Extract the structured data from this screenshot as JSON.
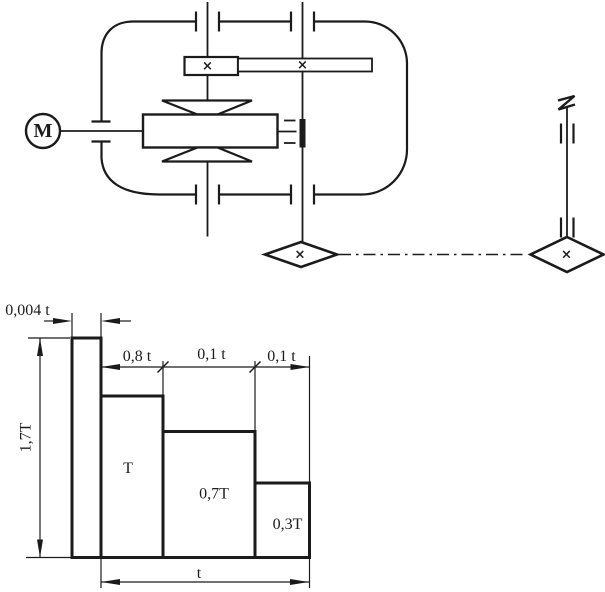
{
  "colors": {
    "ink": "#1b1b1b",
    "paper": "#ffffff"
  },
  "scheme": {
    "motor_label": "M",
    "cross_mark": "×"
  },
  "chart_data": {
    "type": "bar",
    "title": "",
    "x_axis": {
      "unit": "t",
      "total_label": "t"
    },
    "y_axis": {
      "unit": "T"
    },
    "legend": "none",
    "segments": [
      {
        "duration_label": "0,004 t",
        "duration_fraction_of_t": 0.004,
        "torque_label": "1,7T",
        "torque_multiple_of_T": 1.7
      },
      {
        "duration_label": "0,8 t",
        "duration_fraction_of_t": 0.8,
        "torque_label": "T",
        "torque_multiple_of_T": 1.0
      },
      {
        "duration_label": "0,1 t",
        "duration_fraction_of_t": 0.1,
        "torque_label": "0,7T",
        "torque_multiple_of_T": 0.7
      },
      {
        "duration_label": "0,1 t",
        "duration_fraction_of_t": 0.1,
        "torque_label": "0,3T",
        "torque_multiple_of_T": 0.3
      }
    ]
  }
}
